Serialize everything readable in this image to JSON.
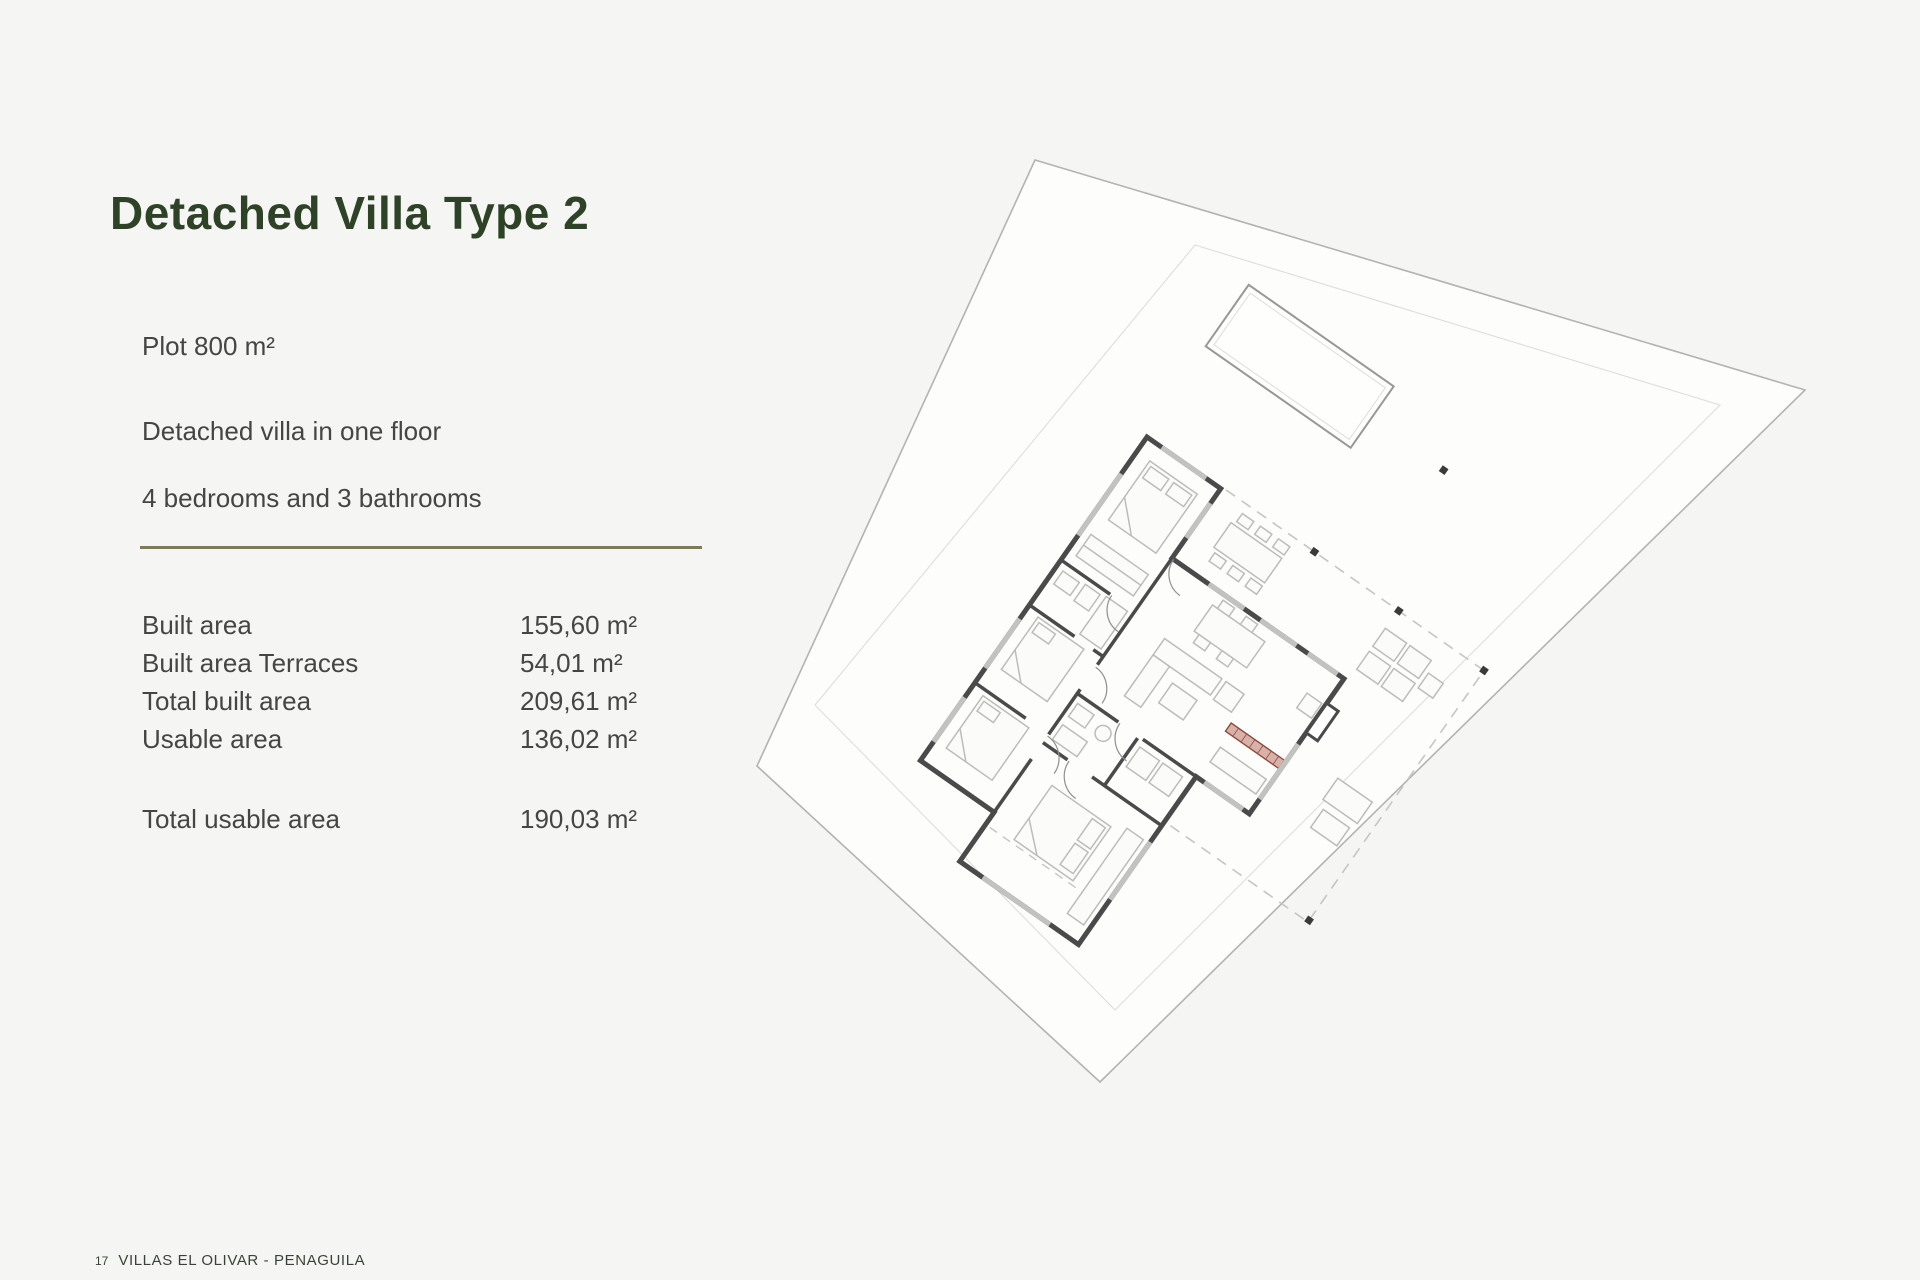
{
  "page": {
    "title": "Detached Villa Type 2"
  },
  "specs": {
    "intro": [
      "Plot 800 m²",
      "Detached villa in one floor",
      "4 bedrooms and 3 bathrooms"
    ],
    "rows": [
      {
        "label": "Built area",
        "value": "155,60 m²"
      },
      {
        "label": "Built area Terraces",
        "value": "54,01 m²"
      },
      {
        "label": "Total built area",
        "value": "209,61 m²"
      },
      {
        "label": "Usable area",
        "value": "136,02 m²"
      }
    ],
    "total": {
      "label": "Total usable area",
      "value": "190,03 m²"
    }
  },
  "footer": {
    "page_number": "17",
    "project": "VILLAS EL OLIVAR - PENAGUILA"
  },
  "plan": {
    "description": "site plan with plot boundary, setback line, pool, roofed terrace outline and furnished one-floor villa floor plan rotated 35 degrees",
    "colors": {
      "title_green": "#2e4227",
      "divider_olive": "#7d7a59",
      "wall_gray": "#4a4a4a",
      "kitchen_accent_stroke": "#8e4c3e",
      "kitchen_accent_fill": "#d8b1a9",
      "plot_line": "#b3b3b1"
    }
  }
}
